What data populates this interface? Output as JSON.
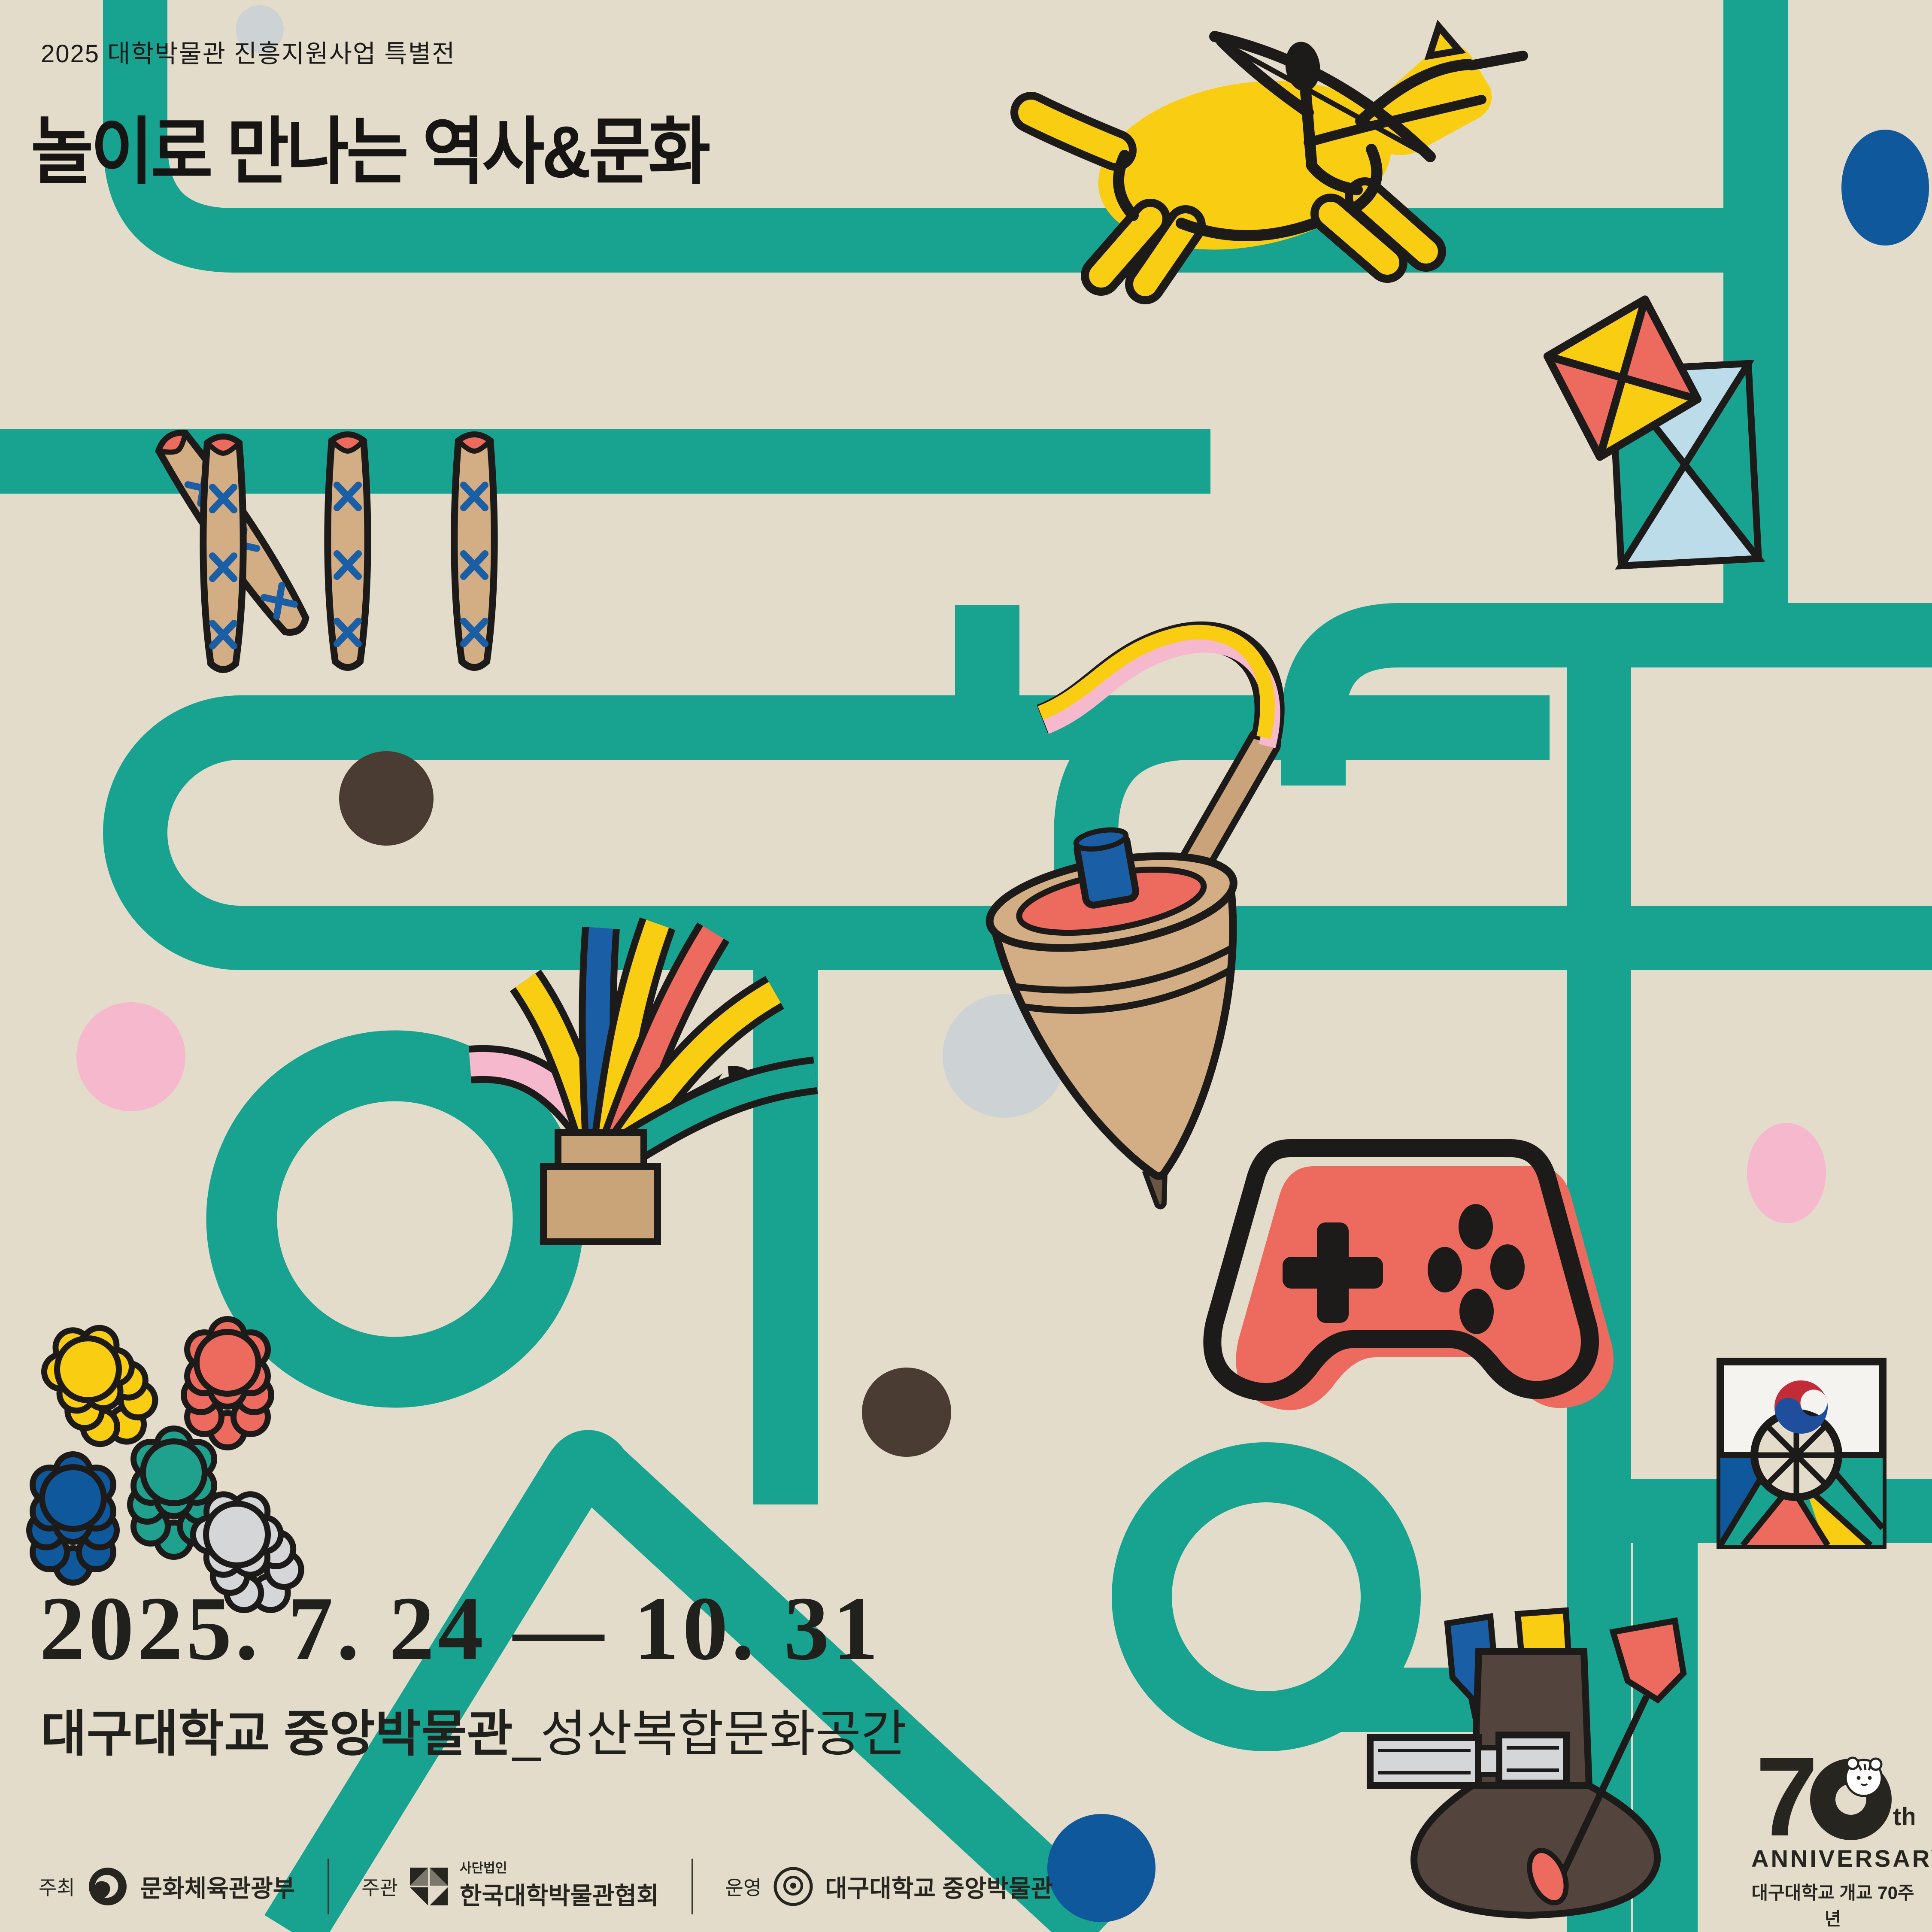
{
  "poster": {
    "eyebrow": "2025 대학박물관 진흥지원사업 특별전",
    "title": "놀이로 만나는 역사&문화",
    "date_range": "2025. 7. 24 — 10. 31",
    "venue": {
      "main": "대구대학교 중앙박물관",
      "annex": "_성산복합문화공간"
    },
    "footer": {
      "host_label": "주최",
      "host_name": "문화체육관광부",
      "org_label": "주관",
      "org_pre": "사단법인",
      "org_name": "한국대학박물관협회",
      "op_label": "운영",
      "op_name": "대구대학교 중앙박물관"
    },
    "anniversary": {
      "number": "70",
      "suffix": "th",
      "word": "ANNIVERSARY",
      "line1": "대구대학교 개교 70주년",
      "year_start": "1956",
      "year_end": "2026",
      "play_icon": "▶"
    },
    "colors": {
      "background": "#E4DCCB",
      "maze_teal": "#17A390",
      "yellow": "#F8CD12",
      "salmon": "#ED6A5E",
      "blue": "#10589C",
      "pink": "#F6B8CC",
      "light_blue": "#BCDCEA",
      "tan": "#D3AE84",
      "dark_brown": "#4A3B33",
      "gray": "#CDD2D4",
      "ink": "#1C1B1A"
    },
    "illustrations": [
      "archer-on-horseback",
      "diamond-kite",
      "square-kite",
      "yut-sticks",
      "spinning-top-with-whip",
      "jegi-shuttlecock",
      "game-controller",
      "flower-game-pieces",
      "ttakji-card",
      "tuho-arrow-pot",
      "tiger-mascot"
    ]
  }
}
